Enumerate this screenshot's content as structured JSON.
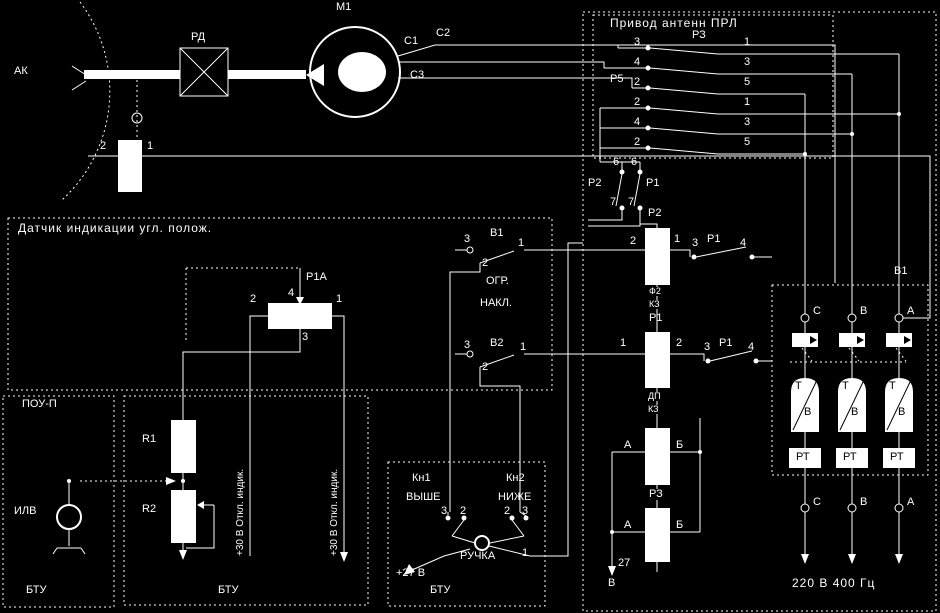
{
  "colors": {
    "background": "#000000",
    "lines": "#ffffff"
  },
  "top": {
    "ak": "АК",
    "rd": "РД",
    "m1": "М1",
    "c1": "С1",
    "c2": "С2",
    "c3": "С3",
    "sensor_t2": "2",
    "sensor_t1": "1"
  },
  "privod": {
    "title": "Привод антенн ПРЛ",
    "relay_top": "РЗ",
    "relay_mid": "Р5",
    "rows": [
      [
        "3",
        "1"
      ],
      [
        "4",
        "3"
      ],
      [
        "2",
        "5"
      ],
      [
        "2",
        "1"
      ],
      [
        "4",
        "3"
      ],
      [
        "2",
        "5"
      ]
    ]
  },
  "control": {
    "p2_contact": "Р2",
    "p1_contact": "Р1",
    "t6": "6",
    "t7": "7",
    "p2_coil": "Р2",
    "p2_t2": "2",
    "p2_t1": "1",
    "contact1": {
      "a": "3",
      "label": "Р1",
      "b": "4"
    },
    "wire1": [
      "Ф2",
      "КЗ"
    ],
    "p1_coil": "Р1",
    "p1_t1": "1",
    "p1_t2": "2",
    "contact2": {
      "a": "3",
      "label": "Р1",
      "b": "4"
    },
    "wire2": [
      "ДП",
      "КЗ"
    ],
    "coil3": {
      "a": "А",
      "b": "Б"
    },
    "r3_label": "РЗ",
    "coil4": {
      "a": "А",
      "b": "Б"
    },
    "v27": "27",
    "v27_unit": "В"
  },
  "limits": {
    "b1": "В1",
    "b2": "В2",
    "t3": "3",
    "t1": "1",
    "t2": "2",
    "caption1": "ОГР.",
    "caption2": "НАКЛ."
  },
  "datchik": {
    "title": "Датчик индикации угл. полож.",
    "pot": "Р1А",
    "t4": "4",
    "t2": "2",
    "t1": "1",
    "t3": "3"
  },
  "pou": {
    "title": "ПОУ-П",
    "lamp": "ИЛВ",
    "dest": "БТУ"
  },
  "rblock": {
    "r1": "R1",
    "r2": "R2",
    "wire_label": "+30 В Откл. индик.",
    "dest": "БТУ"
  },
  "buttons": {
    "kn1": "Кн1",
    "up": "ВЫШЕ",
    "kn2": "Кн2",
    "down": "НИЖЕ",
    "kn1_t3": "3",
    "kn1_t2": "2",
    "kn2_t2": "2",
    "kn2_t3": "3",
    "ruchka": "РУЧКА",
    "ruchka_t1": "1",
    "plus27": "+27 В",
    "dest": "БТУ"
  },
  "power": {
    "block": "В1",
    "phases": [
      "С",
      "В",
      "А"
    ],
    "fuse_t": "Т",
    "fuse_v": "В",
    "rt": "РТ",
    "supply": "220 В 400 Гц"
  }
}
